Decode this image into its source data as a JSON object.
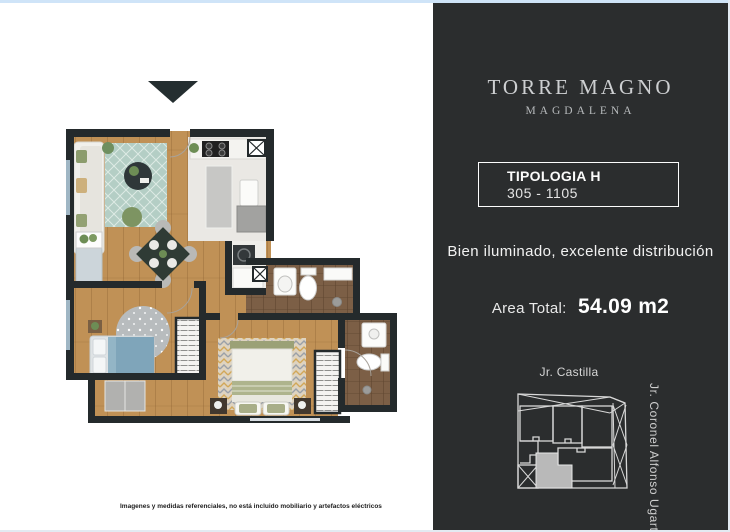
{
  "brand": {
    "title": "TORRE MAGNO",
    "subtitle": "MAGDALENA"
  },
  "typology": {
    "name": "TIPOLOGIA H",
    "range": "305 - 1105"
  },
  "tagline": "Bien iluminado, excelente distribución",
  "area": {
    "label": "Area Total:",
    "value": "54.09 m2"
  },
  "map": {
    "street_top": "Jr. Castilla",
    "street_right": "Jr. Coronel Alfonso Ugarte"
  },
  "disclaimer": "Imagenes y medidas referenciales, no está incluido mobiliario y artefactos eléctricos",
  "colors": {
    "panel_background": "#2b2d2e",
    "top_strip": "#cfe4f8",
    "plan_walls": "#242a2c",
    "wood_floor": "#c09156",
    "kitchen_floor": "#eae8e4",
    "bath_floor": "#7c5f46",
    "living_rug": "#b4cec5",
    "bedroom_rug": "#b8bcbe",
    "master_rug": "#ded3c0",
    "bed_blue": "#7fa5ba",
    "bed_sage": "#a8ae88",
    "map_lines": "#d8d8d8",
    "map_highlight_unit": "#b9b9b9",
    "entry_arrow": "#242e30"
  }
}
